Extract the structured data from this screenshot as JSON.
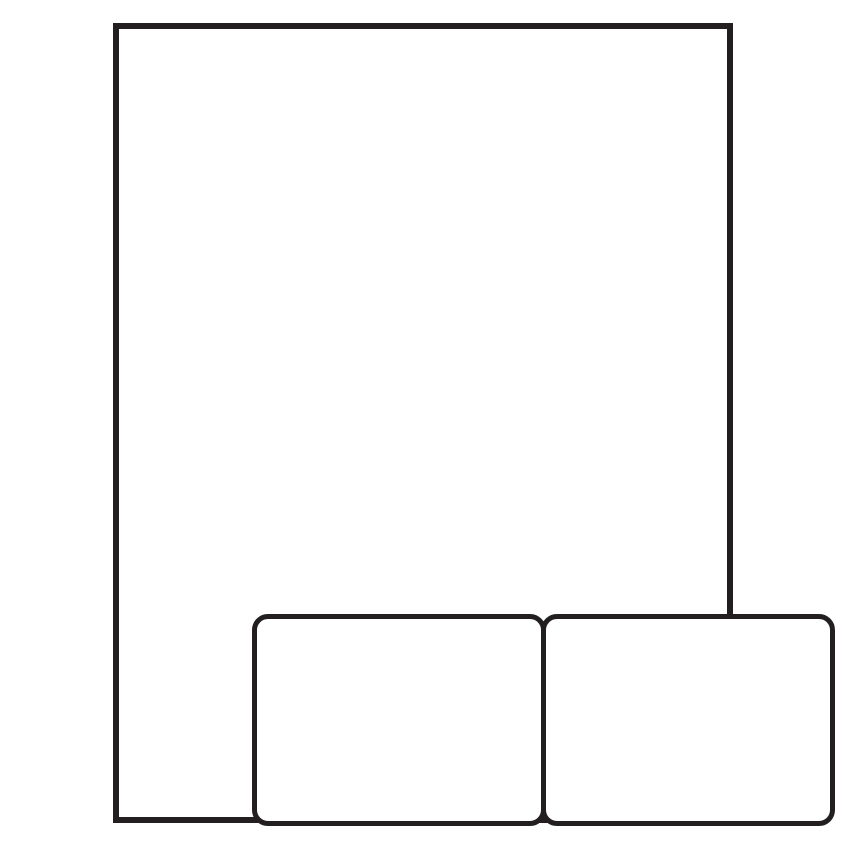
{
  "colors": {
    "line": "#231f20",
    "background": "#ffffff"
  },
  "diagram": {
    "shapes": [
      {
        "name": "sheet-outline",
        "type": "rectangle",
        "corners": "square",
        "fill": "none",
        "stroke": "#231f20"
      },
      {
        "name": "label-bottom-left",
        "type": "rounded-rectangle",
        "corners": "rounded",
        "fill": "none",
        "stroke": "#231f20"
      },
      {
        "name": "label-bottom-right",
        "type": "rounded-rectangle",
        "corners": "rounded",
        "fill": "none",
        "stroke": "#231f20"
      }
    ],
    "text": []
  }
}
